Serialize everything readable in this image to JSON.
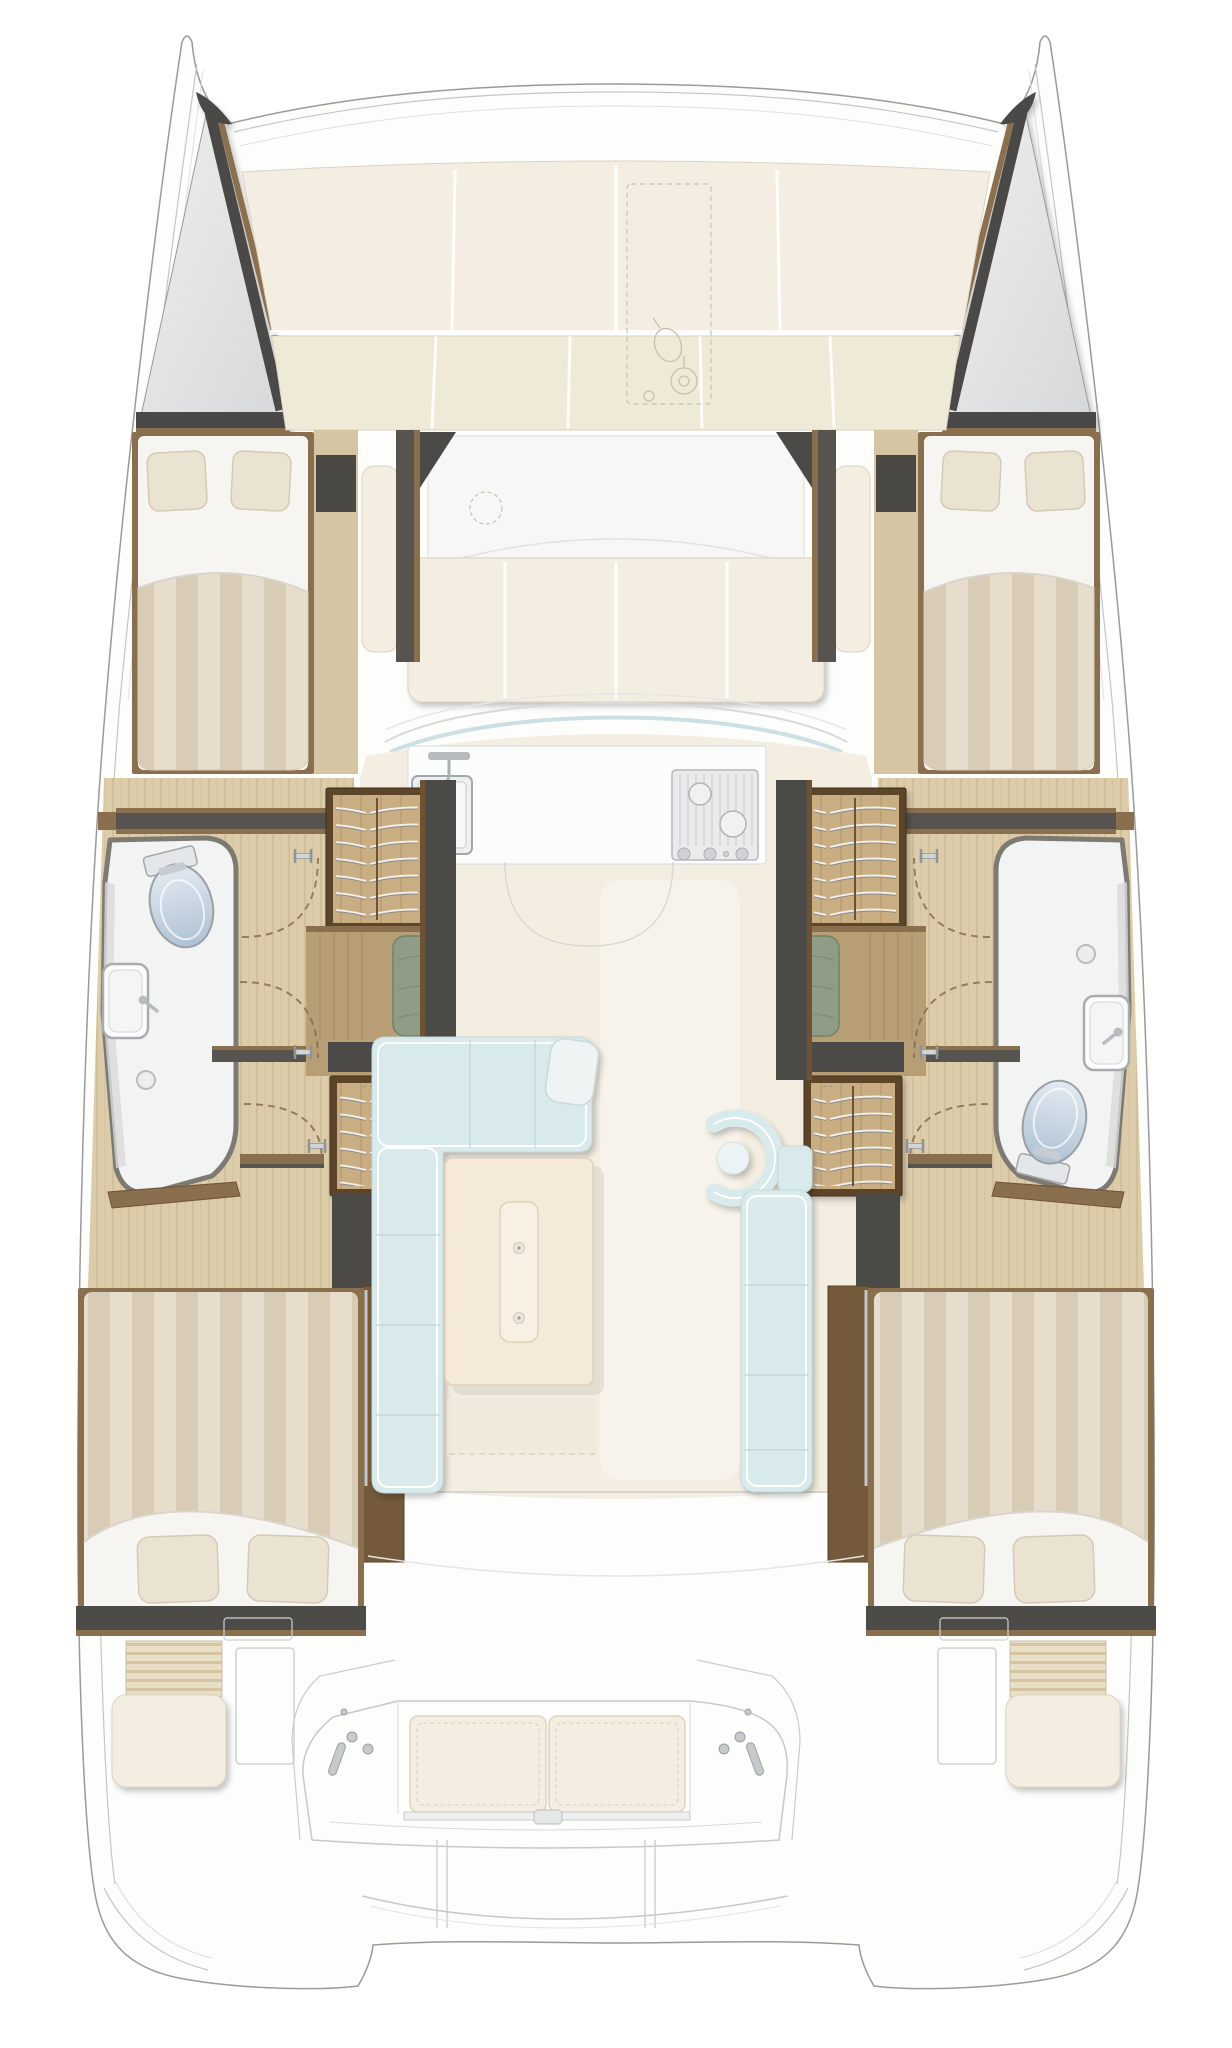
{
  "title": "Catamaran interior layout floor plan, bow at top",
  "diagram_type": "boat-floor-plan",
  "orientation": "bow-top",
  "rooms": {
    "boat_hull": "Catamaran twin-hull outline with stern swim platform",
    "port_bow_locker": "Port bow storage locker",
    "starboard_bow_locker": "Starboard bow storage locker",
    "foredeck_sunpad": "Foredeck sunbathing cushions",
    "anchor_hatch": "Anchor locker hatch with windlass",
    "forward_cockpit": "Forward cockpit lounge seating",
    "windshield": "Coachroof front windows",
    "galley": "Galley counter with sink and stove",
    "saloon": "Saloon with sofas, armchair and table",
    "port_forward_cabin": "Port forward double cabin",
    "starboard_forward_cabin": "Starboard forward double cabin",
    "port_bathroom": "Port bathroom with toilet, washbasin and shower",
    "starboard_bathroom": "Starboard bathroom with shower, washbasin and toilet",
    "port_aft_cabin": "Port aft double cabin",
    "starboard_aft_cabin": "Starboard aft double cabin",
    "port_hull_corridor": "Port hull corridor",
    "starboard_hull_corridor": "Starboard hull corridor",
    "aft_cockpit": "Aft cockpit bench seat",
    "port_stern_seat": "Port stern seat with steps",
    "starboard_stern_seat": "Starboard stern seat with steps",
    "swim_platform": "Stern platform with dinghy davits"
  },
  "fixtures": {
    "toilet": "toilet",
    "washbasin": "washbasin with faucet",
    "shower_drain": "shower drain",
    "galley_sink": "galley sink with faucet",
    "stove": "three-burner stove",
    "wardrobe": "wardrobe with shelves",
    "hull_seat": "hull seat with green cushion",
    "table": "saloon table on pedestal",
    "door_handle": "door handle",
    "door_swing": "door swing arc"
  },
  "colors": {
    "outline": "#9a9a9a",
    "outline_light": "#c4c6c6",
    "deck": "#fdfdfc",
    "locker_a": "#efefef",
    "locker_b": "#d7d8da",
    "dark_wall": "#4c4a46",
    "dark_wall2": "#57544f",
    "wood_trim": "#8a6f4e",
    "wood_dark": "#6e5233",
    "wood_frame": "#5d452c",
    "wood_bar": "#74593a",
    "floor_wood": "#ddcca9",
    "floor_grain": "#c7b48e",
    "wardrobe_wood": "#c9ae84",
    "wardrobe_grain": "#b3946a",
    "shelf_light": "#efefec",
    "shelf_dark": "#8f8b84",
    "cushion_ivory": "#f3eee1",
    "cushion_ivory2": "#efe9d8",
    "cushion_edge": "#ddd3c0",
    "bed_stripe_a": "#e7ddcc",
    "bed_stripe_b": "#d9ccb6",
    "sheet": "#f6f5f2",
    "fold": "#d9d5cd",
    "pillow": "#ebe3d2",
    "pillow_edge": "#d4cab5",
    "sofa_blue": "#d9eaec",
    "sofa_edge": "#c3dbde",
    "sofa_line": "#bed7da",
    "sofa_piping": "#ffffff",
    "table": "#f5ead9",
    "table_edge": "#e0d2ba",
    "saloon_floor": "#f4ede1",
    "walkway": "#f9f4ec",
    "green": "#8f9c86",
    "green_dark": "#72816a",
    "bath_floor": "#f2f3f3",
    "bath_rim": "#7d7a74",
    "bath_shade": "#d9dadb",
    "toilet_a": "#e3ebf2",
    "toilet_b": "#aec1d3",
    "fixture": "#a8acaf",
    "fixture_light": "#d0d4d6",
    "counter": "#fbfcfc",
    "stove": "#e9ebec",
    "stove_line": "#c6cacc",
    "metal": "#c3c7ca",
    "arc_dash": "#8a6f50",
    "detail": "#c9cccd",
    "steps_a": "#e9dec6",
    "steps_b": "#d5c4a0",
    "bench_wood": "#b79e74",
    "bench_plank": "#a58c62"
  }
}
